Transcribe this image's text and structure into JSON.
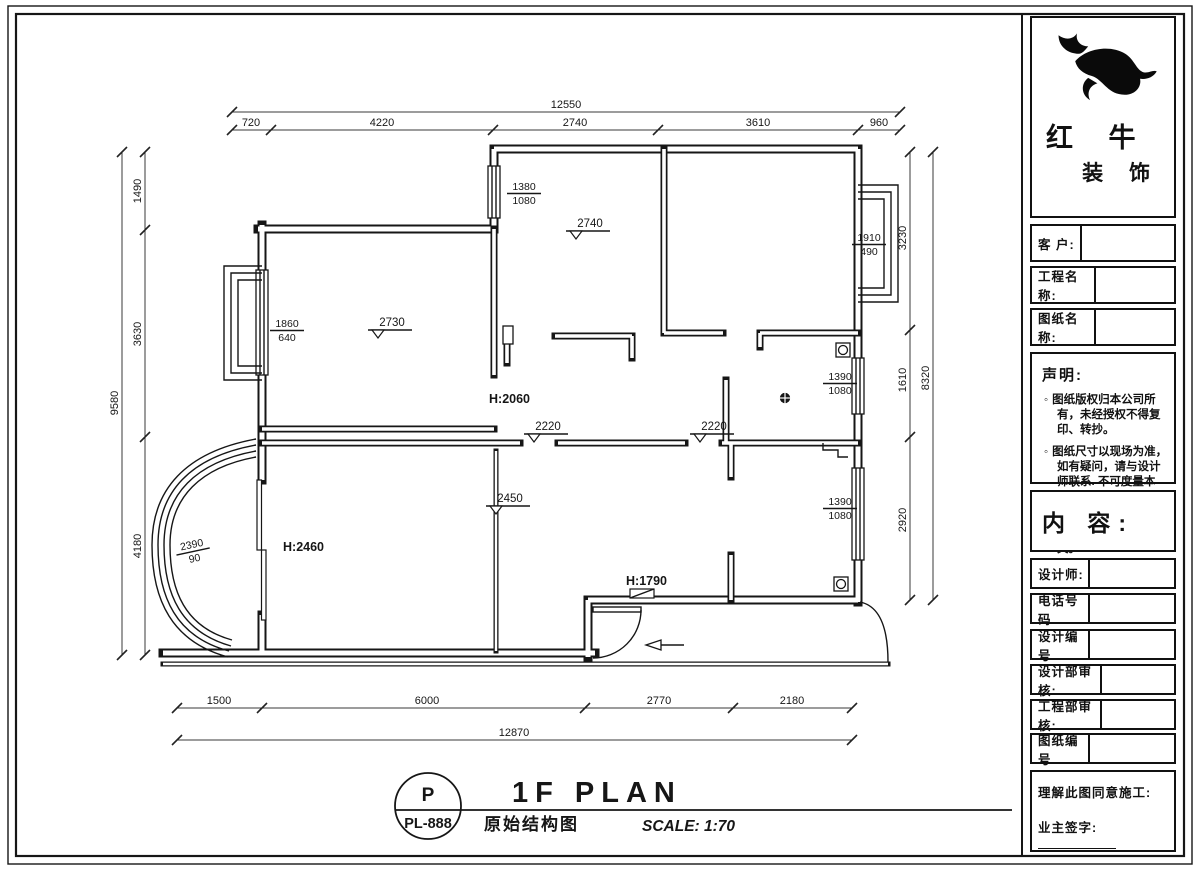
{
  "title_block": {
    "logo": {
      "brand_top": "红 牛",
      "brand_bottom": "装 饰",
      "mark": "bull-logo"
    },
    "fields": [
      {
        "label": "客  户:"
      },
      {
        "label": "工程名称:"
      },
      {
        "label": "图纸名称:"
      }
    ],
    "statement": {
      "heading": "声明:",
      "items": [
        "图纸版权归本公司所有，未经授权不得复印、转抄。",
        "图纸尺寸以现场为准，如有疑问，请与设计师联系. 不可度量本图。",
        "因弥补建筑缺陷造成的费用增加与设计无关。"
      ]
    },
    "content_heading": "内 容:",
    "fields2": [
      {
        "label": "设计师:"
      },
      {
        "label": "电话号码"
      },
      {
        "label": "设计编号"
      },
      {
        "label": "设计部审核:"
      },
      {
        "label": "工程部审核:"
      },
      {
        "label": "图纸编号"
      }
    ],
    "approval": {
      "line1": "理解此图同意施工:",
      "line2": "业主签字:"
    }
  },
  "footer": {
    "stamp_letter": "P",
    "drawing_no": "PL-888",
    "title_en": "1F PLAN",
    "title_cn": "原始结构图",
    "scale": "SCALE: 1:70"
  },
  "plan": {
    "dimensions": {
      "top": {
        "overall": "12550",
        "segments": [
          "720",
          "4220",
          "2740",
          "3610",
          "960"
        ]
      },
      "left": {
        "overall": "9580",
        "segments": [
          "1490",
          "3630",
          "4180"
        ]
      },
      "right": {
        "overall": "8320",
        "segments": [
          "3230",
          "1610",
          "2920"
        ]
      },
      "bottom": {
        "overall": "12870",
        "segments": [
          "1500",
          "6000",
          "2770",
          "2180"
        ]
      }
    },
    "window_labels": [
      {
        "num": "1380",
        "den": "1080"
      },
      {
        "num": "1860",
        "den": "640"
      },
      {
        "num": "1910",
        "den": "490"
      },
      {
        "num": "1390",
        "den": "1080"
      },
      {
        "num": "1390",
        "den": "1080"
      },
      {
        "num": "2390",
        "den": "90"
      }
    ],
    "level_marks": [
      "2740",
      "2730",
      "2220",
      "2220",
      "2450"
    ],
    "height_labels": [
      "H:2060",
      "H:2460",
      "H:1790"
    ]
  }
}
